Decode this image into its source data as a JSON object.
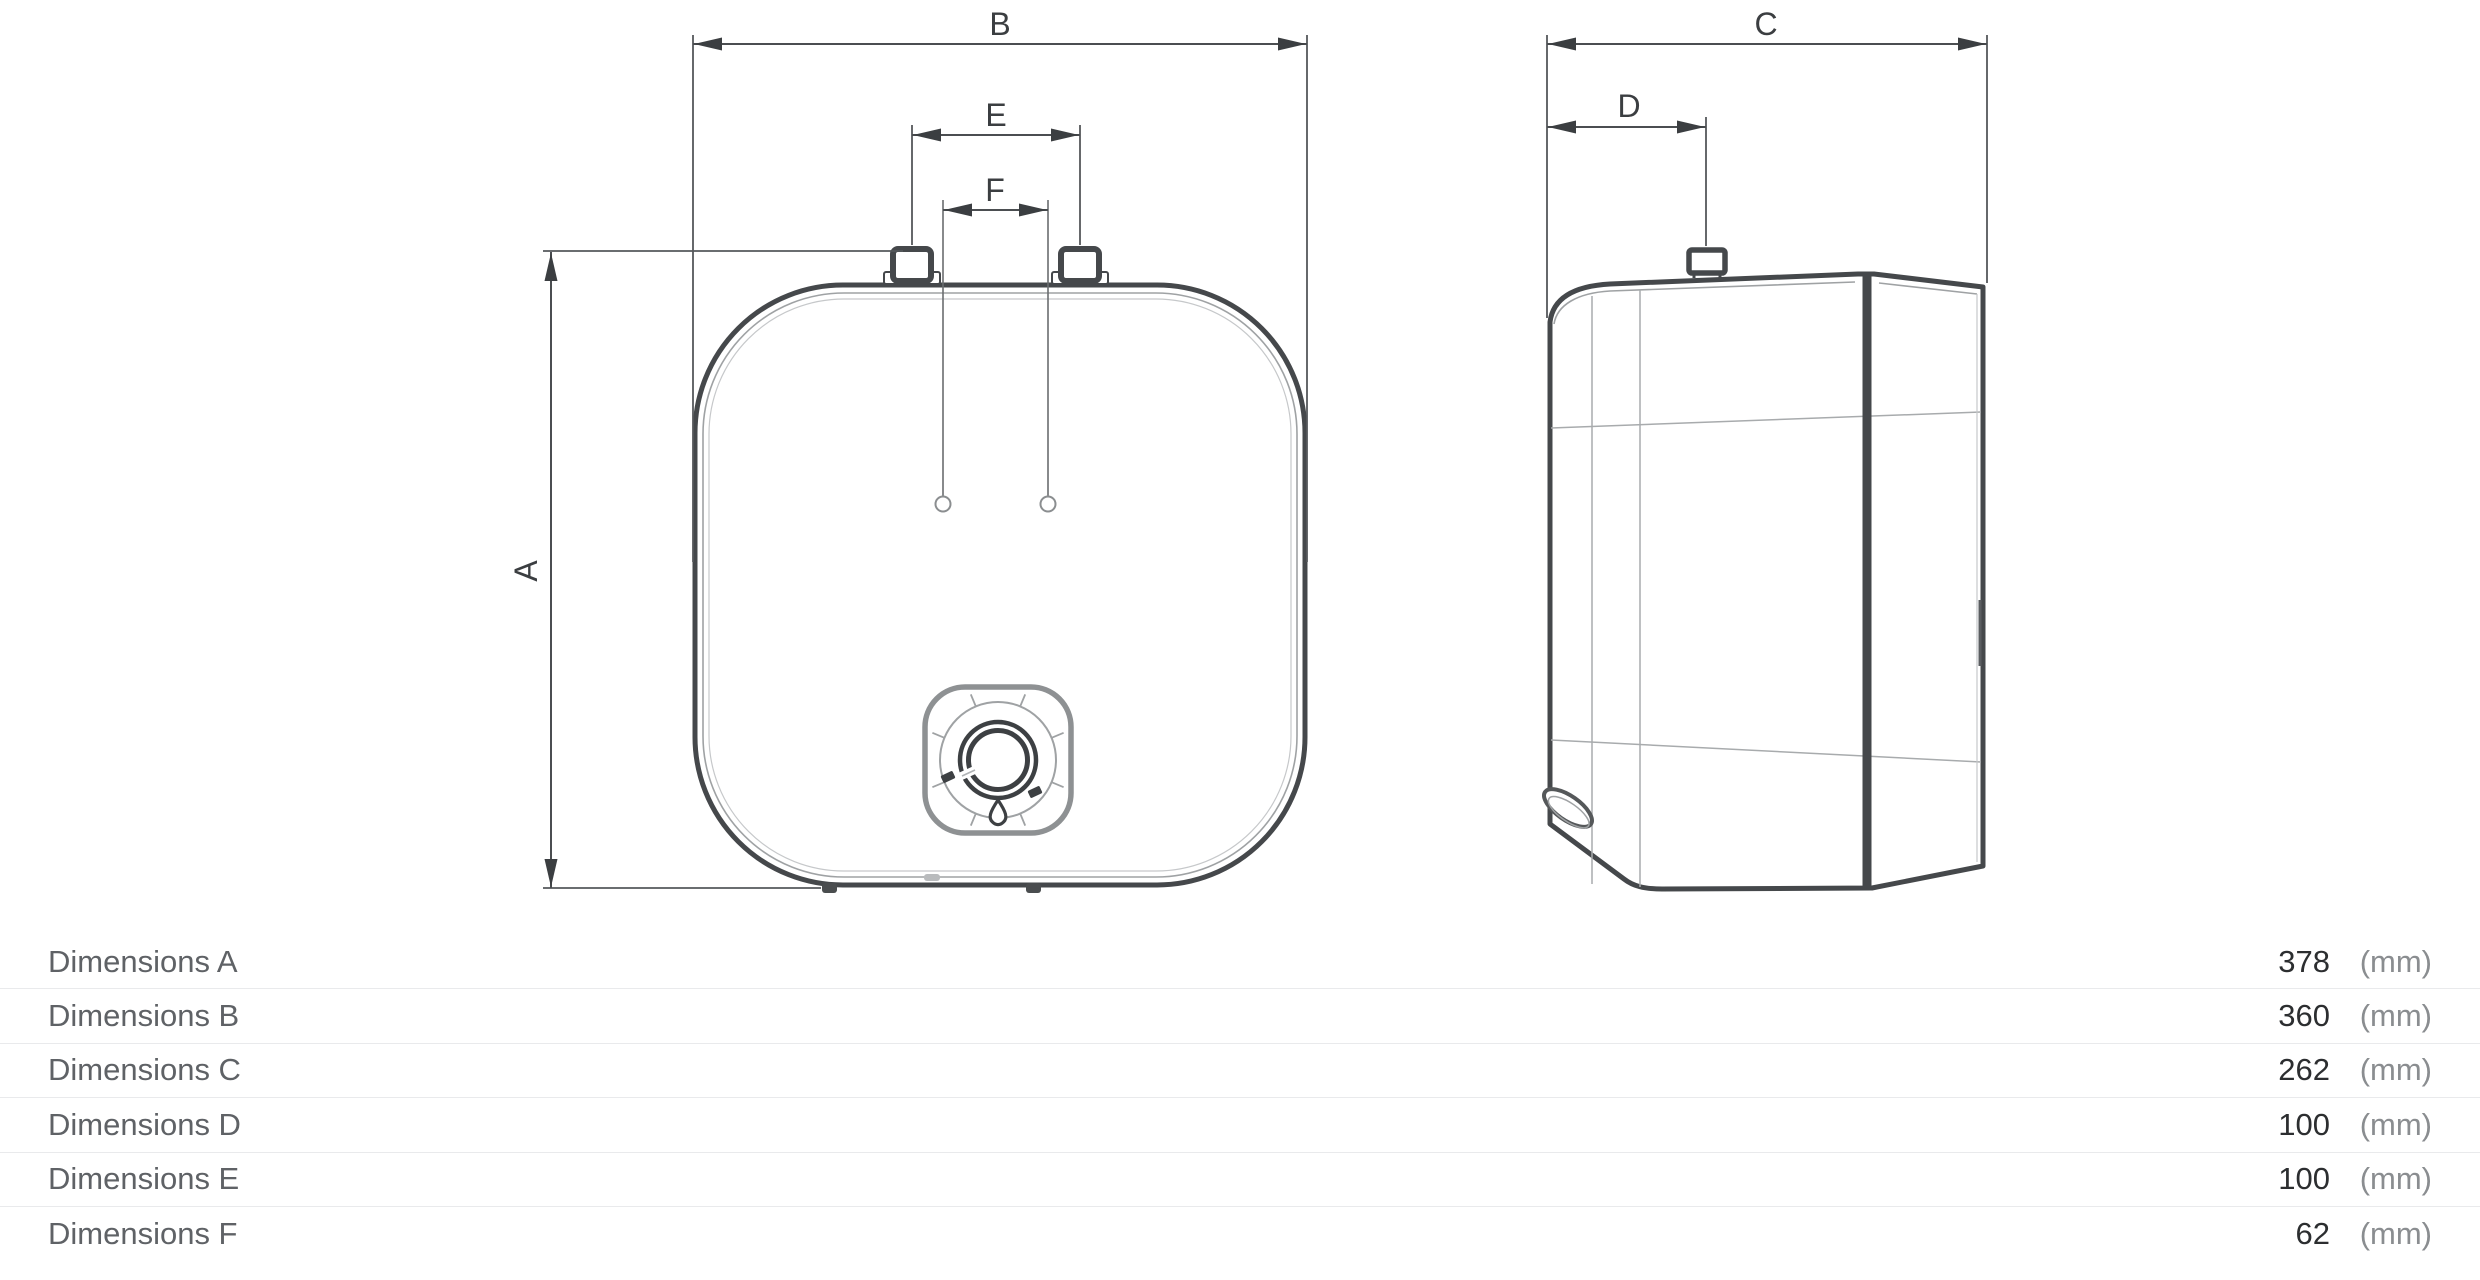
{
  "drawing": {
    "labels": {
      "A": "A",
      "B": "B",
      "C": "C",
      "D": "D",
      "E": "E",
      "F": "F"
    }
  },
  "dimensions_table": {
    "rows": [
      {
        "label": "Dimensions A",
        "value": "378",
        "unit": "(mm)"
      },
      {
        "label": "Dimensions B",
        "value": "360",
        "unit": "(mm)"
      },
      {
        "label": "Dimensions C",
        "value": "262",
        "unit": "(mm)"
      },
      {
        "label": "Dimensions D",
        "value": "100",
        "unit": "(mm)"
      },
      {
        "label": "Dimensions E",
        "value": "100",
        "unit": "(mm)"
      },
      {
        "label": "Dimensions F",
        "value": "62",
        "unit": "(mm)"
      }
    ]
  },
  "colors": {
    "outline_dark": "#45484b",
    "outline_thin": "#9fa2a4",
    "dimension_line": "#4b4e51",
    "label_text": "#5f6266",
    "value_text": "#2c2e30",
    "unit_text": "#8a8d90",
    "separator": "#e9eaec"
  }
}
